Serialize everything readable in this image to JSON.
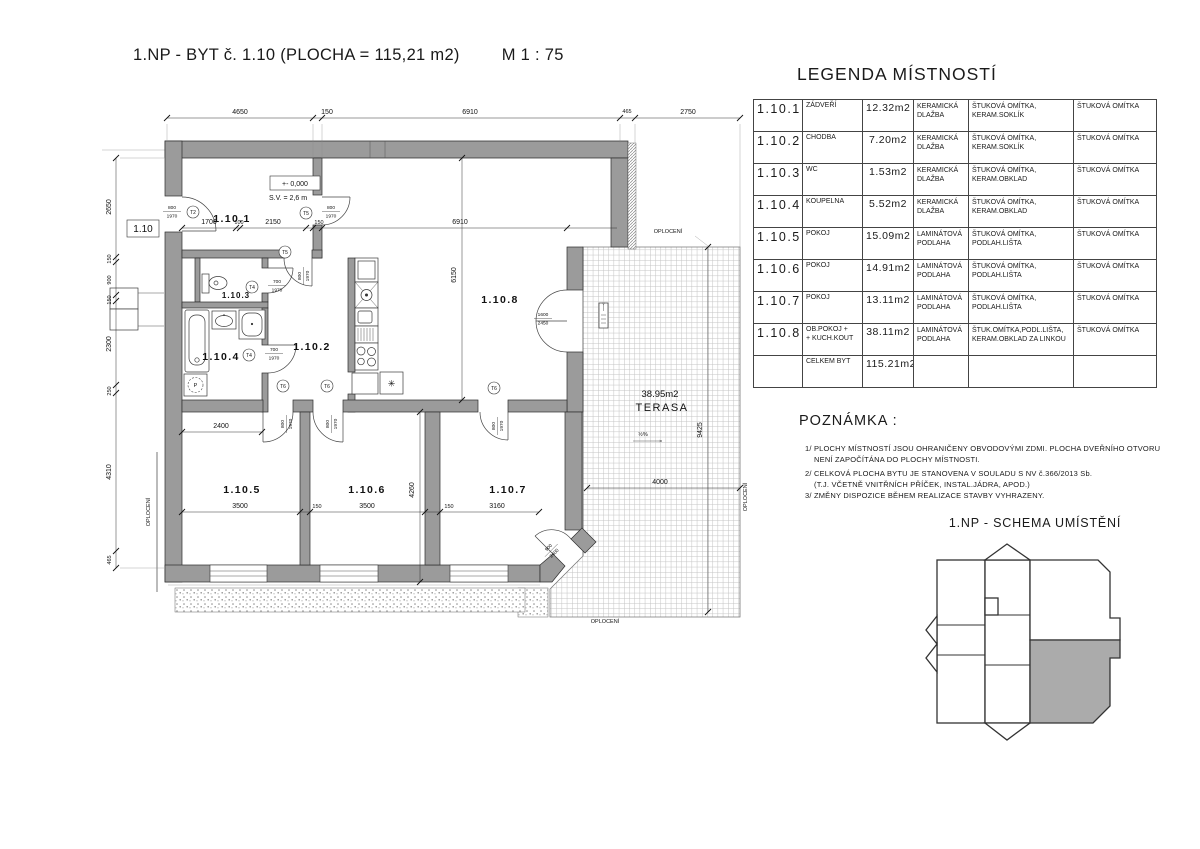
{
  "header": {
    "title": "1.NP - BYT č. 1.10 (PLOCHA = 115,21 m2)",
    "scale": "M 1 : 75"
  },
  "legend": {
    "title": "LEGENDA MÍSTNOSTÍ",
    "rows": [
      {
        "id": "1.10.1",
        "name": "ZÁDVEŘÍ",
        "name2": "",
        "area": "12.32m2",
        "floor1": "KERAMICKÁ",
        "floor2": "DLAŽBA",
        "wall1": "ŠTUKOVÁ OMÍTKA,",
        "wall2": "KERAM.SOKLÍK",
        "ceiling": "ŠTUKOVÁ OMÍTKA"
      },
      {
        "id": "1.10.2",
        "name": "CHODBA",
        "name2": "",
        "area": "7.20m2",
        "floor1": "KERAMICKÁ",
        "floor2": "DLAŽBA",
        "wall1": "ŠTUKOVÁ OMÍTKA,",
        "wall2": "KERAM.SOKLÍK",
        "ceiling": "ŠTUKOVÁ OMÍTKA"
      },
      {
        "id": "1.10.3",
        "name": "WC",
        "name2": "",
        "area": "1.53m2",
        "floor1": "KERAMICKÁ",
        "floor2": "DLAŽBA",
        "wall1": "ŠTUKOVÁ OMÍTKA,",
        "wall2": "KERAM.OBKLAD",
        "ceiling": "ŠTUKOVÁ OMÍTKA"
      },
      {
        "id": "1.10.4",
        "name": "KOUPELNA",
        "name2": "",
        "area": "5.52m2",
        "floor1": "KERAMICKÁ",
        "floor2": "DLAŽBA",
        "wall1": "ŠTUKOVÁ OMÍTKA,",
        "wall2": "KERAM.OBKLAD",
        "ceiling": "ŠTUKOVÁ OMÍTKA"
      },
      {
        "id": "1.10.5",
        "name": "POKOJ",
        "name2": "",
        "area": "15.09m2",
        "floor1": "LAMINÁTOVÁ",
        "floor2": "PODLAHA",
        "wall1": "ŠTUKOVÁ OMÍTKA,",
        "wall2": "PODLAH.LIŠTA",
        "ceiling": "ŠTUKOVÁ OMÍTKA"
      },
      {
        "id": "1.10.6",
        "name": "POKOJ",
        "name2": "",
        "area": "14.91m2",
        "floor1": "LAMINÁTOVÁ",
        "floor2": "PODLAHA",
        "wall1": "ŠTUKOVÁ OMÍTKA,",
        "wall2": "PODLAH.LIŠTA",
        "ceiling": "ŠTUKOVÁ OMÍTKA"
      },
      {
        "id": "1.10.7",
        "name": "POKOJ",
        "name2": "",
        "area": "13.11m2",
        "floor1": "LAMINÁTOVÁ",
        "floor2": "PODLAHA",
        "wall1": "ŠTUKOVÁ OMÍTKA,",
        "wall2": "PODLAH.LIŠTA",
        "ceiling": "ŠTUKOVÁ OMÍTKA"
      },
      {
        "id": "1.10.8",
        "name": "OB.POKOJ +",
        "name2": "+ KUCH.KOUT",
        "area": "38.11m2",
        "floor1": "LAMINÁTOVÁ",
        "floor2": "PODLAHA",
        "wall1": "ŠTUK.OMÍTKA,PODL.LIŠTA,",
        "wall2": "KERAM.OBKLAD ZA LINKOU",
        "ceiling": "ŠTUKOVÁ OMÍTKA"
      },
      {
        "id": "",
        "name": "CELKEM BYT",
        "name2": "",
        "area": "115.21m2",
        "floor1": "",
        "floor2": "",
        "wall1": "",
        "wall2": "",
        "ceiling": ""
      }
    ]
  },
  "notes": {
    "title": "POZNÁMKA :",
    "lines": [
      {
        "t": "1/ PLOCHY MÍSTNOSTÍ JSOU OHRANIČENY OBVODOVÝMI ZDMI. PLOCHA DVEŘNÍHO OTVORU"
      },
      {
        "t": "NENÍ ZAPOČÍTÁNA DO PLOCHY MÍSTNOSTI."
      },
      {
        "t": "2/ CELKOVÁ PLOCHA BYTU JE STANOVENA V SOULADU S NV č.366/2013 Sb."
      },
      {
        "t": "(T.J. VČETNĚ VNITŘNÍCH PŘÍČEK, INSTAL.JÁDRA, APOD.)"
      },
      {
        "t": "3/ ZMĚNY DISPOZICE BĚHEM REALIZACE STAVBY VYHRAZENY."
      }
    ]
  },
  "schema": {
    "title": "1.NP - SCHEMA UMÍSTĚNÍ",
    "highlight_color": "#ababab"
  },
  "plan": {
    "apartment_tag": "1.10",
    "level": "+- 0,000",
    "ceiling_height": "S.V. = 2,6 m",
    "rooms": {
      "r1": "1.10.1",
      "r2": "1.10.2",
      "r3": "1.10.3",
      "r4": "1.10.4",
      "r5": "1.10.5",
      "r6": "1.10.6",
      "r7": "1.10.7",
      "r8": "1.10.8"
    },
    "terrace": {
      "area": "38.95m2",
      "name": "TERASA",
      "slope": "½%"
    },
    "fence": "OPLOCENÍ",
    "dims": {
      "top": [
        "4650",
        "150",
        "6910",
        "465",
        "2750"
      ],
      "left": [
        "2650",
        "150",
        "900",
        "150",
        "2300",
        "250",
        "4310",
        "465"
      ],
      "inner": [
        "1700",
        "100",
        "2150",
        "150",
        "6910"
      ],
      "bottom": [
        "3500",
        "150",
        "3500",
        "150",
        "3160"
      ],
      "v6150": "6150",
      "v4260": "4260",
      "w2400": "2400",
      "t4000": "4000",
      "t9425": "9425"
    },
    "doors": {
      "d800w": "800",
      "d800h": "1970",
      "d700w": "700",
      "d700h": "1970",
      "d1600w": "1600",
      "d1600h": "2450",
      "d900w": "900",
      "d900h": "2400"
    },
    "tags": {
      "t2": "T2",
      "t4": "T4",
      "t5": "T5",
      "t6": "T6"
    },
    "fixtures": {
      "washer": "P",
      "boiler": "✳"
    }
  }
}
